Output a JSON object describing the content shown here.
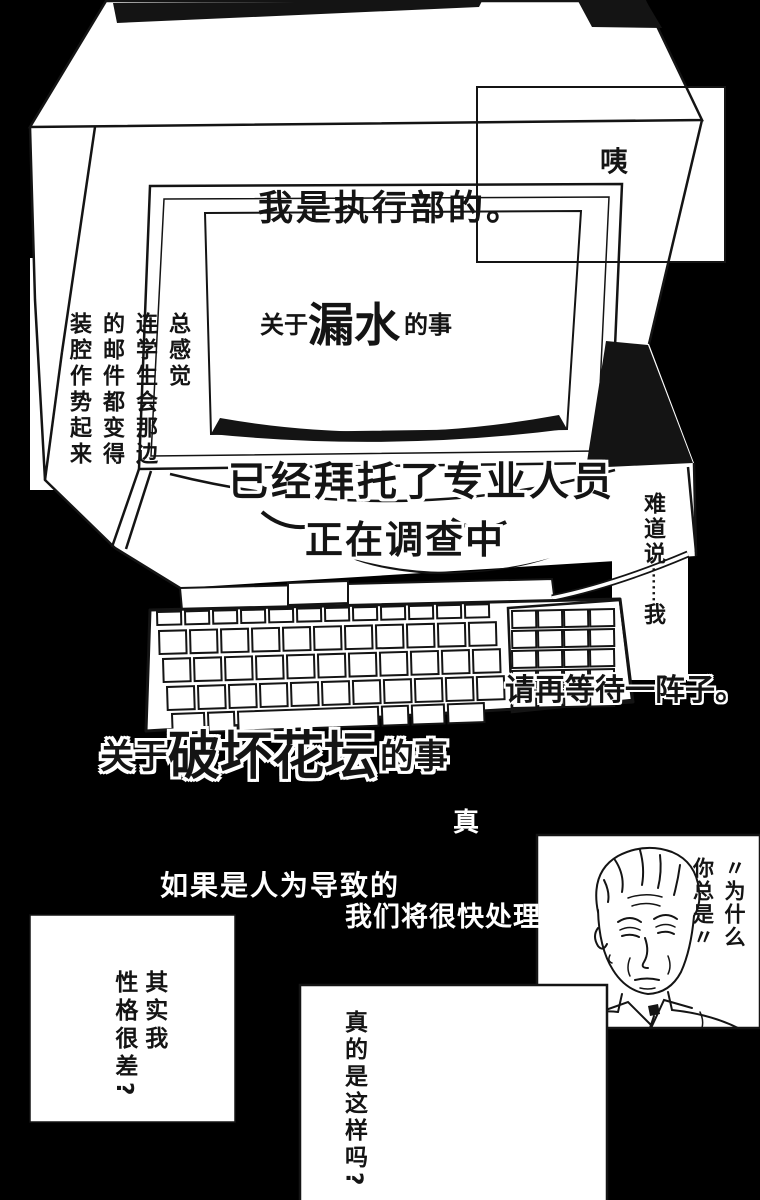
{
  "page": {
    "background_color": "#000000",
    "panel_color": "#ffffff",
    "ink_color": "#141414"
  },
  "bubbles": {
    "surprise": "咦",
    "screen_line1": "我是执行部的。",
    "screen_line2_prefix": "关于",
    "screen_line2_big": "漏水",
    "screen_line2_suffix": "的事",
    "left_monologue": "总感觉\n连学生会那边\n的邮件都变得\n装腔作势起来",
    "caption_investigate_1": "已经拜托了专业人员",
    "caption_investigate_2": "正在调查中",
    "doubt_pre": "难道说",
    "doubt_dots": "······",
    "doubt_post": "我",
    "wait": "请再等待一阵子。",
    "flowerbed_prefix": "关于",
    "flowerbed_big": "破坏花坛",
    "flowerbed_suffix": "的事",
    "truth_fragment": "真",
    "cond_line1": "如果是人为导致的",
    "cond_line2": "我们将很快处理",
    "portrait_quote": "〃为什么\n你总是〃",
    "self_doubt": "其实我\n性格很差?",
    "really_question": "真的是这样吗?"
  },
  "illustrations": {
    "monitor": "crt-monitor",
    "keyboard": "keyboard",
    "portrait": "tired-man-face"
  }
}
